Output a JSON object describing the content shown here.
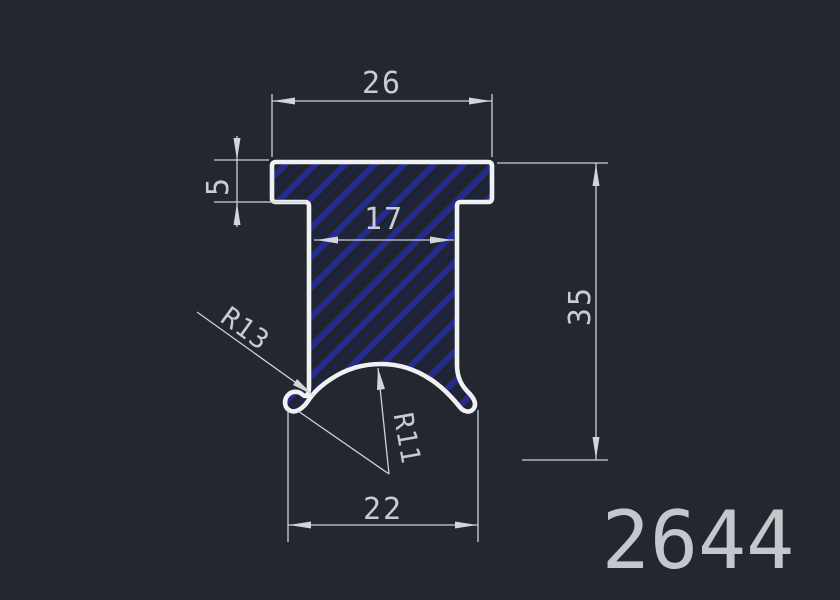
{
  "colors": {
    "background": "#232830",
    "profile_outline": "#eff1f3",
    "hatch_line": "#242a8e",
    "hatch_line_faint": "#1b2166",
    "hatch_base": "#20242d",
    "dimension_lines": "#ccd1d5",
    "dimension_text": "#c7ccd0"
  },
  "drawing": {
    "part_number": "2644",
    "dimensions": {
      "top_width": "26",
      "flange_thickness": "5",
      "stem_width": "17",
      "overall_height": "35",
      "bottom_width": "22",
      "outer_lip_radius": "R13",
      "groove_radius": "R11"
    }
  }
}
